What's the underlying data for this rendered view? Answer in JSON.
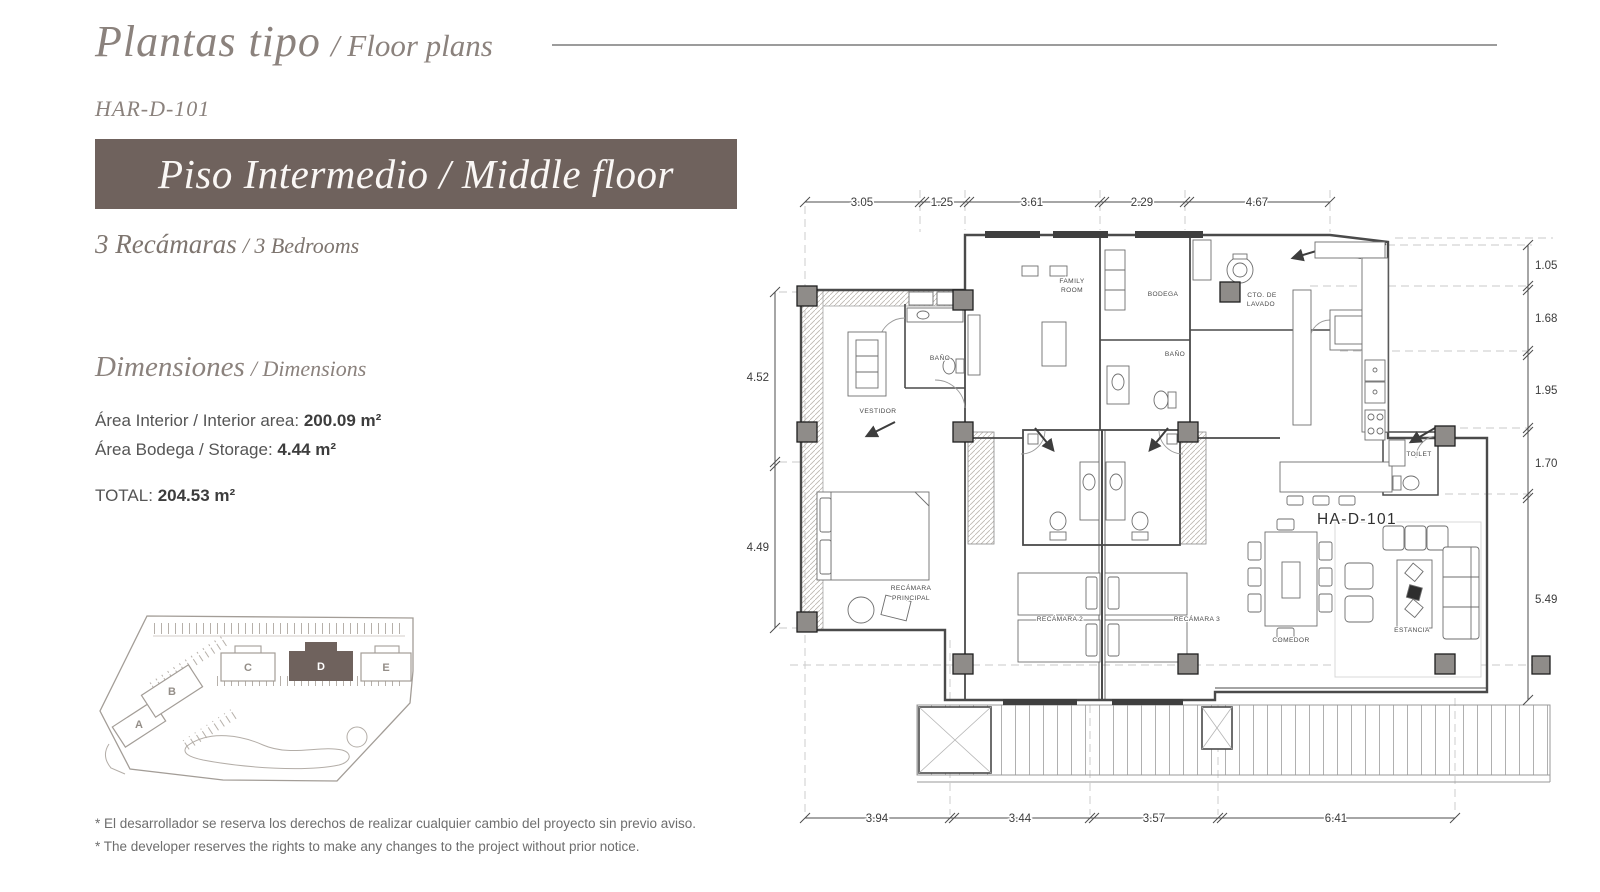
{
  "header": {
    "title_es": "Plantas tipo",
    "title_en": "/ Floor plans",
    "unit_code": "HAR-D-101",
    "banner": "Piso Intermedio / Middle floor",
    "bedrooms_es": "3 Recámaras",
    "bedrooms_en": "/ 3 Bedrooms"
  },
  "dimensions_section": {
    "heading_es": "Dimensiones",
    "heading_en": "/ Dimensions",
    "interior_label": "Área Interior / Interior area:",
    "interior_value": "200.09 m²",
    "storage_label": "Área Bodega / Storage:",
    "storage_value": "4.44 m²",
    "total_label": "TOTAL:",
    "total_value": "204.53 m²"
  },
  "site_map": {
    "buildings": [
      "A",
      "B",
      "C",
      "D",
      "E"
    ],
    "highlighted_building": "D"
  },
  "floor_plan": {
    "plan_code": "HA-D-101",
    "dims_top": [
      "3.05",
      "1.25",
      "3.61",
      "2.29",
      "4.67"
    ],
    "dims_right": [
      "1.05",
      "1.68",
      "1.95",
      "1.70",
      "5.49"
    ],
    "dims_left": [
      "4.52",
      "4.49"
    ],
    "dims_bottom": [
      "3.94",
      "3.44",
      "3.57",
      "6.41"
    ],
    "rooms": {
      "family_room_line1": "FAMILY",
      "family_room_line2": "ROOM",
      "bodega": "BODEGA",
      "cto_lavado_line1": "CTO. DE",
      "cto_lavado_line2": "LAVADO",
      "bano_secondary": "BAÑO",
      "bano_master": "BAÑO",
      "vestidor": "VESTIDOR",
      "recamara_principal_line1": "RECÁMARA",
      "recamara_principal_line2": "PRINCIPAL",
      "recamara_2": "RECÁMARA 2",
      "recamara_3": "RECÁMARA 3",
      "comedor": "COMEDOR",
      "estancia": "ESTANCIA",
      "toilet": "TOILET"
    }
  },
  "footnotes": {
    "es": "* El desarrollador se reserva los derechos de realizar cualquier cambio del proyecto sin previo aviso.",
    "en": "* The developer reserves the rights to make any changes to the project without prior notice."
  },
  "colors": {
    "accent_taupe": "#6F625D",
    "heading_gray": "#8B827D",
    "plan_line": "#4A4A4A"
  }
}
